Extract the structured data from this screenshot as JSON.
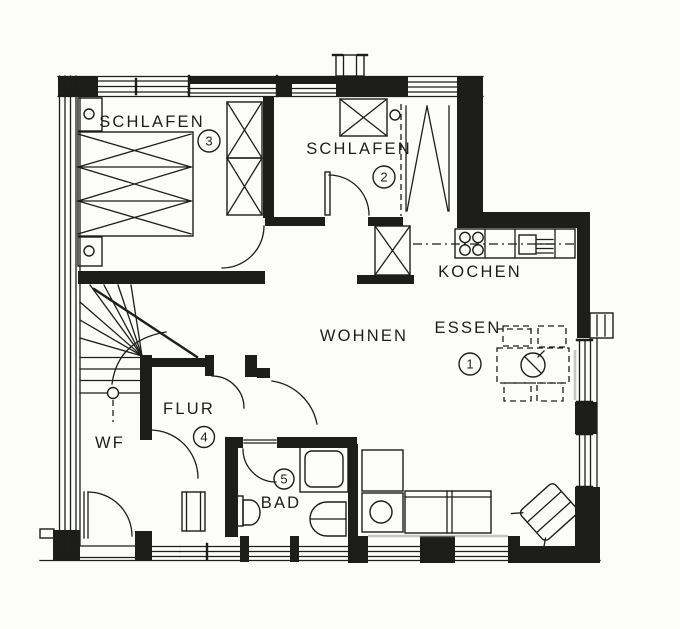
{
  "colors": {
    "ink": "#1d1d1b",
    "paper": "#fcfcfa"
  },
  "rooms": [
    {
      "id": "schlafen-3",
      "label": "SCHLAFEN",
      "number": "3"
    },
    {
      "id": "schlafen-2",
      "label": "SCHLAFEN",
      "number": "2"
    },
    {
      "id": "kochen",
      "label": "KOCHEN",
      "number": ""
    },
    {
      "id": "essen",
      "label": "ESSEN",
      "number": "1"
    },
    {
      "id": "wohnen",
      "label": "WOHNEN",
      "number": ""
    },
    {
      "id": "flur",
      "label": "FLUR",
      "number": "4"
    },
    {
      "id": "bad",
      "label": "BAD",
      "number": "5"
    },
    {
      "id": "wf",
      "label": "WF",
      "number": ""
    }
  ],
  "icons": [
    "bed-icon",
    "nightstand-icon",
    "wardrobe-icon",
    "stove-icon",
    "sink-icon",
    "drainboard-icon",
    "fridge-icon",
    "dining-table-icon",
    "chair-icon",
    "sofa-icon",
    "armchair-icon",
    "side-table-icon",
    "stairs-icon",
    "toilet-icon",
    "bathtub-icon",
    "shower-icon",
    "door-arc-icon",
    "window-icon",
    "chimney-icon"
  ]
}
